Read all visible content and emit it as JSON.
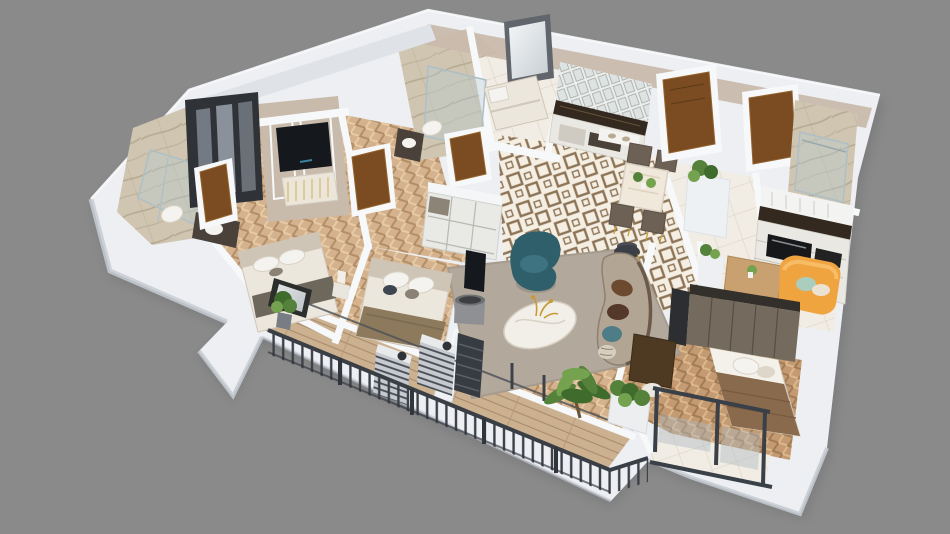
{
  "scene": {
    "type": "3d-apartment-floor-plan-render",
    "view": "isometric-cutaway",
    "background": "#8a8a8a"
  },
  "palette": {
    "background": "#8a8a8a",
    "wallTop": "#edeff2",
    "wallBright": "#f6f8fa",
    "wallSide": "#c7ccd3",
    "beigeWall": "#c9bbac",
    "beigeDark": "#b2a492",
    "woodFloor": "#d5b28e",
    "woodLight": "#e7cba6",
    "woodDark": "#b28e66",
    "wood2": "#c49a72",
    "wood2Light": "#dcb88c",
    "wood2Dark": "#a07b54",
    "tileBase": "#f4eee3",
    "tileMotif": "#8d7456",
    "liteTile": "#f1ede5",
    "liteLine": "#ddd6c8",
    "marble": "#cfc5b0",
    "marbleStreak": "#a99d85",
    "glass": "#aebfc6",
    "doorWood": "#7b4c22",
    "doorLight": "#95642e",
    "darkUnit": "#2f3338",
    "graphite": "#3e434a",
    "rail": "#3a3f46",
    "rug": "#b2a89b",
    "sofa": "#b3a593",
    "teal": "#2f5f6b",
    "tealLight": "#3e7482",
    "tealPillow": "#4e7d87",
    "brownPillow": "#6b4a30",
    "darkBrown": "#54382a",
    "orange": "#f0a440",
    "orangeLight": "#f6bc66",
    "plantDark": "#3f6b2c",
    "plant": "#55823a",
    "plantLight": "#74a24e",
    "gold": "#c79b33",
    "white": "#f4f3f0",
    "bedding": "#ece7dd",
    "headboard": "#cfc5b6",
    "blanketBrown": "#8a6a4c",
    "blanketGray": "#6e675c",
    "counter": "#33291f",
    "lamp": "#8e9093",
    "tv": "#15181c",
    "shadow": "#5e6166"
  },
  "rooms": [
    {
      "id": "master-bathroom",
      "furniture": [
        "glass-shower",
        "vanity",
        "sink",
        "toilet"
      ]
    },
    {
      "id": "master-bedroom",
      "furniture": [
        "wardrobe-mirrored",
        "tv-wall",
        "tv-console",
        "double-bed",
        "nightstand-lamp",
        "entry-door",
        "window",
        "potted-plant"
      ]
    },
    {
      "id": "hallway-closet",
      "furniture": [
        "wood-door",
        "shelving-unit"
      ]
    },
    {
      "id": "guest-bathroom",
      "furniture": [
        "glass-shower",
        "toilet",
        "vanity",
        "wood-door"
      ]
    },
    {
      "id": "maid-room",
      "furniture": [
        "single-bed",
        "window"
      ]
    },
    {
      "id": "kitchen",
      "furniture": [
        "glass-upper-cabinets",
        "stone-counter",
        "open-shelves"
      ]
    },
    {
      "id": "dining-area",
      "furniture": [
        "marble-dining-table",
        "dining-chairs",
        "table-plants",
        "side-cylinder-table",
        "console-with-bowls"
      ]
    },
    {
      "id": "entry-foyer",
      "furniture": [
        "entry-door-1",
        "entry-door-2",
        "partition-with-plant"
      ]
    },
    {
      "id": "shower-bathroom",
      "furniture": [
        "glass-shower"
      ]
    },
    {
      "id": "kitchen-counter-right",
      "furniture": [
        "upper-cabinets",
        "stone-counter",
        "built-in-oven",
        "drawer-cabinets"
      ]
    },
    {
      "id": "living-room",
      "furniture": [
        "area-rug",
        "swivel-armchair-teal",
        "round-coffee-table",
        "gold-branch-decor",
        "curved-sofa",
        "throw-pillows",
        "drum-floor-lamp",
        "candle"
      ]
    },
    {
      "id": "bedroom-2",
      "furniture": [
        "double-bed",
        "shelf-unit",
        "parapet-tv"
      ]
    },
    {
      "id": "kids-bedroom",
      "furniture": [
        "wardrobe",
        "single-bed",
        "desk",
        "chair",
        "recessed-window-balcony"
      ]
    },
    {
      "id": "study-lounge",
      "furniture": [
        "orange-loveseat",
        "wood-console-table",
        "plant",
        "dark-cabinet"
      ]
    },
    {
      "id": "balcony",
      "furniture": [
        "metal-railing",
        "ac-unit-1",
        "ac-unit-2",
        "slatted-screen",
        "palm-plant",
        "planter-box",
        "potted-plant",
        "framed-window"
      ]
    }
  ]
}
